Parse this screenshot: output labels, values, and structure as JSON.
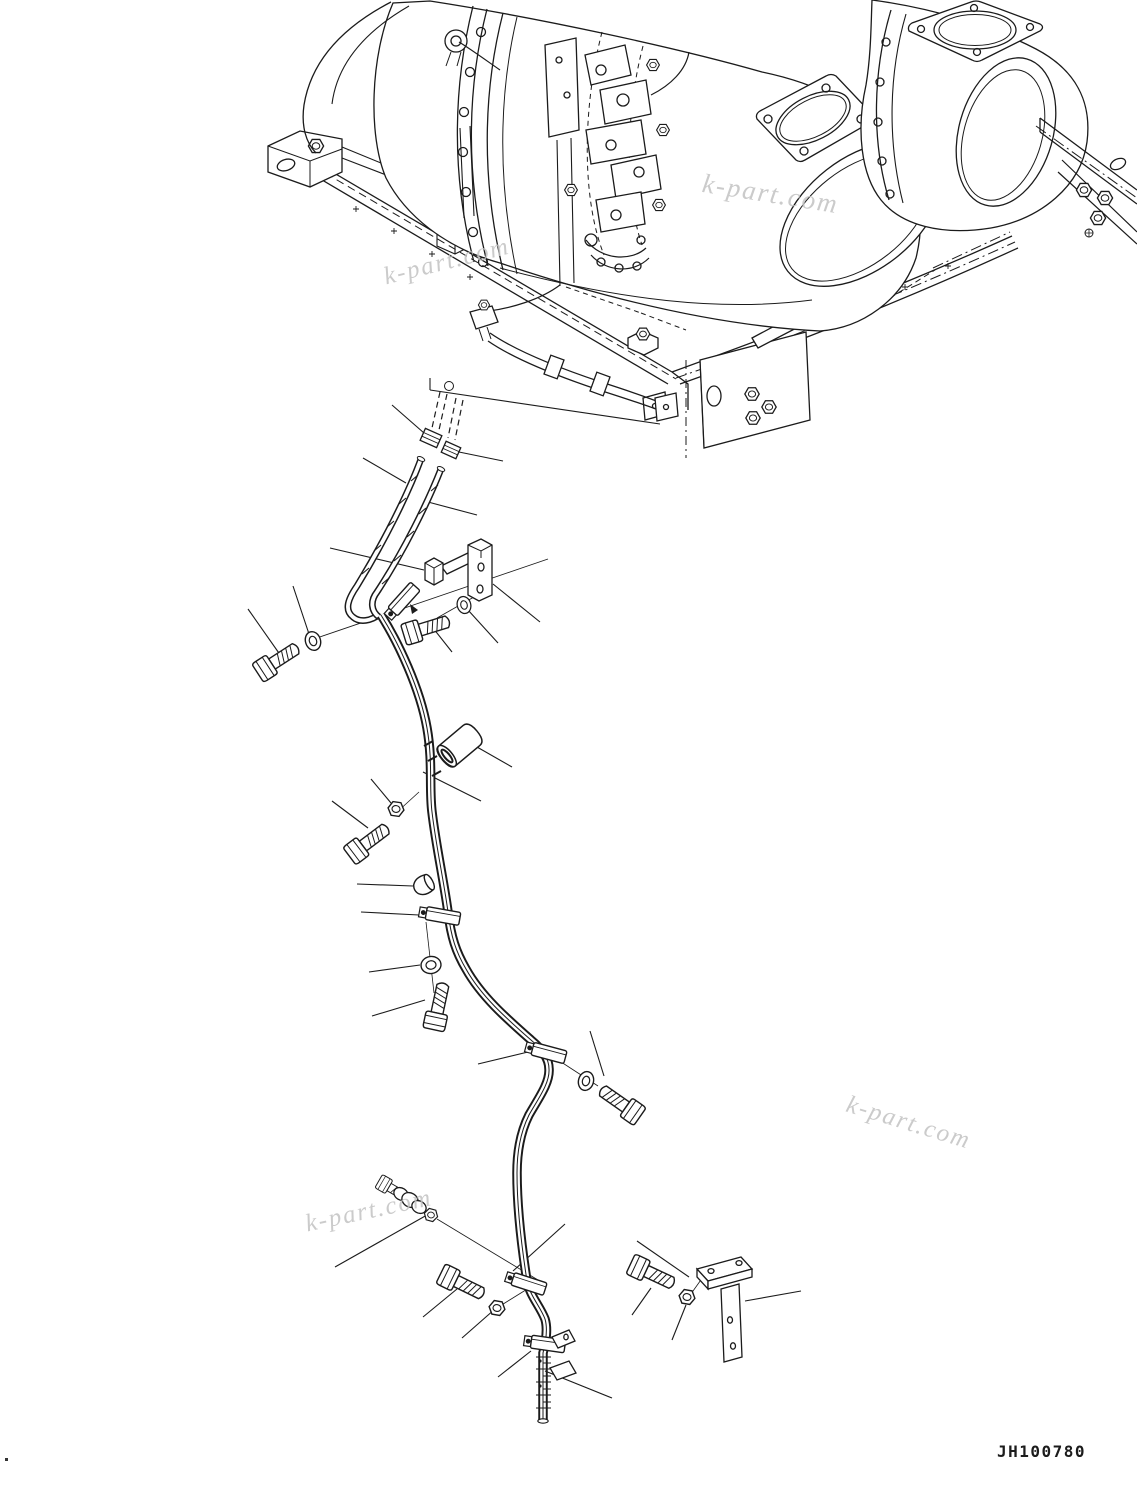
{
  "page": {
    "width": 1137,
    "height": 1491,
    "background_color": "#ffffff",
    "line_color": "#1b1b1b",
    "watermark_color": "#c2c2c2"
  },
  "title_block": {
    "drawing_number": "JH100780"
  },
  "watermark": {
    "text": "k-part.com",
    "instances": 4
  },
  "figure": {
    "type": "exploded-parts-line-drawing",
    "subject": "muffler mounting frame and tube routing with fasteners",
    "visible_parts": [
      "muffler-canister-left",
      "muffler-canister-right",
      "mounting-frame",
      "valve-cluster",
      "frame-fuel-line",
      "tube-assembly",
      "tube-clamp",
      "hex-bolt",
      "washer",
      "nut",
      "cap-nut",
      "spacer",
      "l-bracket",
      "t-bracket"
    ]
  }
}
